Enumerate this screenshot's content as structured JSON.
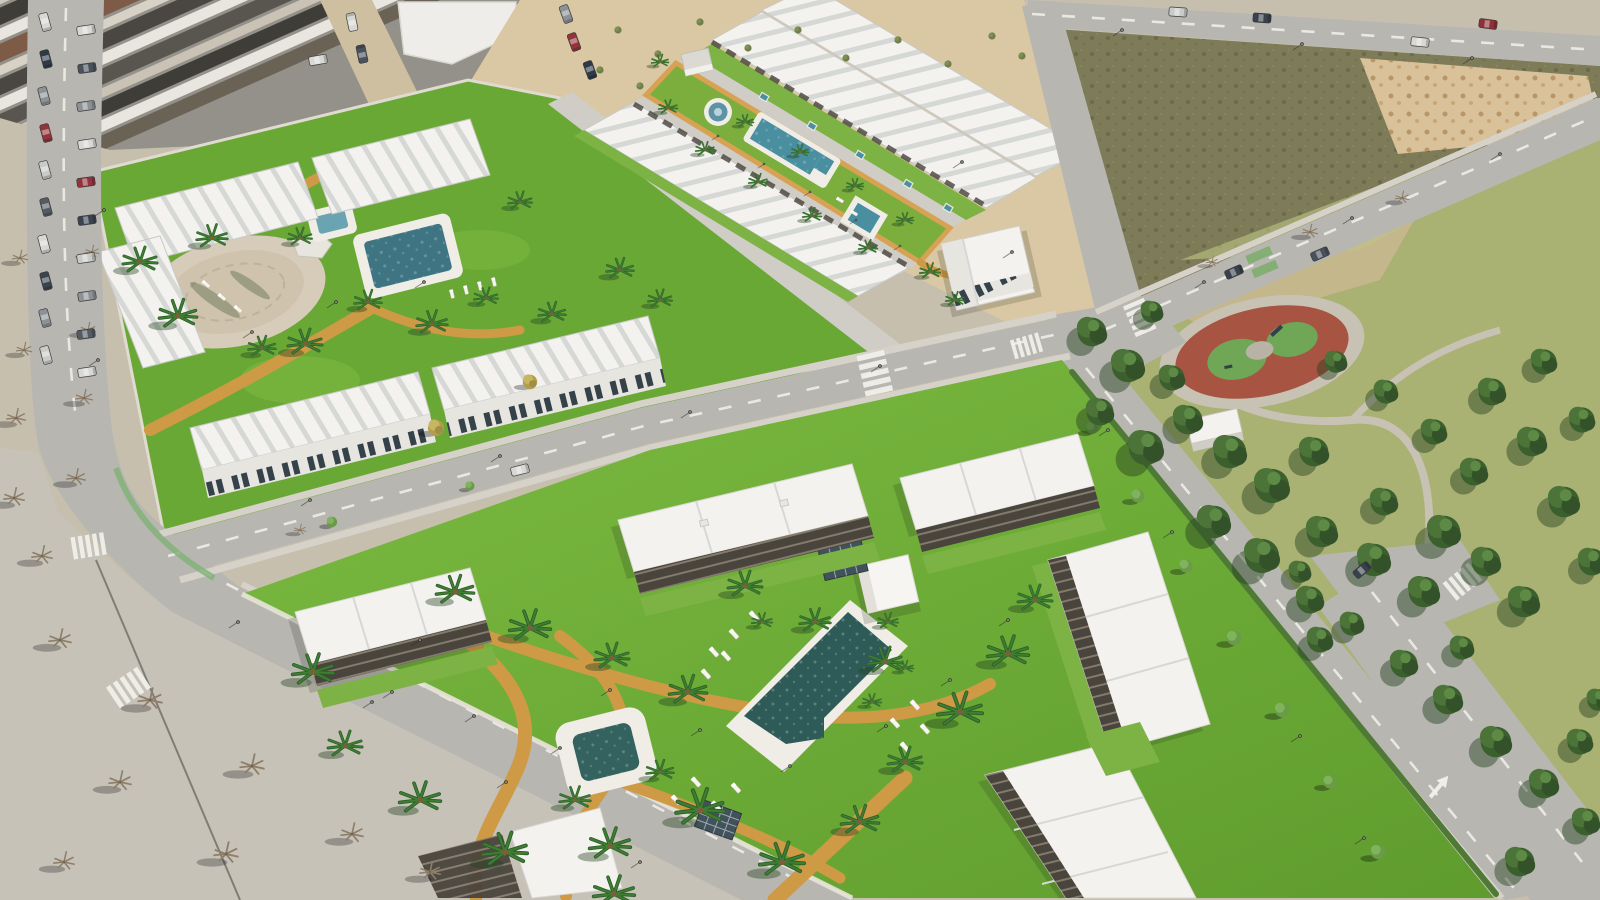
{
  "scene": {
    "description": "Oblique aerial 3D architectural render of two new-build white residential complexes with communal lawns, swimming pools and palm trees, beside an existing town, empty plots, a tree-filled public park with a red playground, and surrounding streets.",
    "view": "oblique aerial",
    "texts_visible": "none"
  },
  "regions": {
    "town": {
      "label": "existing town blocks with dark roofs and parked cars"
    },
    "left_street": {
      "label": "street with parked cars on both sides"
    },
    "plaza": {
      "label": "paved area with bare trees and long shadows"
    },
    "sand_lots": {
      "label": "sandy undeveloped strip"
    },
    "scrub_field": {
      "label": "dark scrub vacant plot"
    },
    "mound_field": {
      "label": "sandy plot with planting mounds"
    },
    "park": {
      "label": "public park with dense pines",
      "playground": "red circular playground with green play surfaces"
    },
    "dev_a": {
      "label": "upper-left residence community: lawns, round patio, two pools, townhouse rows"
    },
    "dev_b": {
      "label": "long strip community: central lawn with fountain, lap pool, plunge pool, flanking townhouse rows, corner villa"
    },
    "dev_c": {
      "label": "lower community: large lawn, main pool, square plunge pool, pergola cube, apartment blocks"
    },
    "roads": {
      "label": "asphalt roads with zebra crossings, dashes, turn arrow and street lamps"
    }
  },
  "colors": {
    "base": "#c6bfae",
    "town": "#94918a",
    "road": "#b7b6b1",
    "sidewalk": "#d6d2c9",
    "plaza": "#c6c2b8",
    "sand": "#d9c8a3",
    "scrub": "#7d7b58",
    "mound": "#d9c29a",
    "parkGrass": "#a9b173",
    "parkSand": "#c9b891",
    "lawnA": "#6aa836",
    "lawnC1": "#7cbb41",
    "lawnC2": "#5f9c2e",
    "stripLawn": "#7bae3c",
    "path": "#cf9a45",
    "deck": "#efede6",
    "water": "#2e5a58",
    "waterLight": "#4a8fa0",
    "roofWhite": "#f3f2ef",
    "roofShade": "#d6d8d6",
    "faceShade": "#e7e5e0",
    "windowDark": "#35424a",
    "pergola": "#49443c",
    "hedge": "#4e7a35",
    "garden": "#7cb344",
    "wall": "#e0dbd0",
    "lane": "#d0cdc6",
    "playRed": "#a85442",
    "playGreen": "#6fa757",
    "playPath": "#c8c2b4",
    "zebra": "#f2f1ec"
  },
  "stamps": [
    [
      "zebra",
      875,
      374,
      1,
      -103
    ],
    [
      "zebra",
      88,
      546,
      0.8,
      -9
    ],
    [
      "zebra",
      128,
      688,
      0.9,
      -34
    ],
    [
      "zebra",
      1140,
      318,
      0.8,
      -113
    ],
    [
      "zebra",
      1462,
      582,
      0.8,
      -39
    ],
    [
      "zebra",
      1026,
      346,
      0.7,
      -16
    ],
    [
      "bike",
      1262,
      262,
      1,
      -113
    ],
    [
      "mpool",
      764,
      97,
      1,
      31
    ],
    [
      "mpool",
      812,
      126,
      1,
      31
    ],
    [
      "mpool",
      860,
      155,
      1,
      31
    ],
    [
      "mpool",
      908,
      184,
      1,
      31
    ],
    [
      "mpool",
      948,
      208,
      1,
      31
    ],
    [
      "lounger",
      714,
      652,
      1,
      48
    ],
    [
      "lounger",
      734,
      634,
      1,
      48
    ],
    [
      "lounger",
      754,
      616,
      1,
      48
    ],
    [
      "lounger",
      706,
      674,
      1,
      48
    ],
    [
      "lounger",
      726,
      656,
      1,
      48
    ],
    [
      "lounger",
      895,
      723,
      1,
      48
    ],
    [
      "lounger",
      915,
      705,
      1,
      48
    ],
    [
      "lounger",
      905,
      747,
      1,
      48
    ],
    [
      "lounger",
      925,
      729,
      1,
      48
    ],
    [
      "lounger",
      676,
      800,
      1,
      48
    ],
    [
      "lounger",
      696,
      782,
      1,
      48
    ],
    [
      "lounger",
      716,
      806,
      1,
      48
    ],
    [
      "lounger",
      736,
      788,
      1,
      48
    ],
    [
      "lounger",
      452,
      294,
      0.8,
      76
    ],
    [
      "lounger",
      466,
      290,
      0.8,
      76
    ],
    [
      "lounger",
      480,
      286,
      0.8,
      76
    ],
    [
      "lounger",
      494,
      282,
      0.8,
      76
    ],
    [
      "lounger",
      206,
      284,
      0.8,
      40
    ],
    [
      "lounger",
      222,
      297,
      0.8,
      40
    ],
    [
      "lounger",
      238,
      309,
      0.8,
      40
    ],
    [
      "lounger",
      840,
      200,
      0.7,
      31
    ],
    [
      "lounger",
      854,
      213,
      0.7,
      31
    ],
    [
      "lamp",
      238,
      622
    ],
    [
      "lamp",
      372,
      702
    ],
    [
      "lamp",
      506,
      782
    ],
    [
      "lamp",
      640,
      862
    ],
    [
      "lamp",
      104,
      210
    ],
    [
      "lamp",
      98,
      360
    ],
    [
      "lamp",
      310,
      500
    ],
    [
      "lamp",
      500,
      456
    ],
    [
      "lamp",
      690,
      412
    ],
    [
      "lamp",
      880,
      366
    ],
    [
      "lamp",
      1204,
      282
    ],
    [
      "lamp",
      1352,
      218
    ],
    [
      "lamp",
      1500,
      154
    ],
    [
      "lamp",
      962,
      162
    ],
    [
      "lamp",
      1012,
      252
    ],
    [
      "lamp",
      1108,
      430
    ],
    [
      "lamp",
      1172,
      532
    ],
    [
      "lamp",
      1236,
      634
    ],
    [
      "lamp",
      1300,
      736
    ],
    [
      "lamp",
      1364,
      838
    ],
    [
      "lamp",
      1122,
      30
    ],
    [
      "lamp",
      1302,
      44
    ],
    [
      "lamp",
      1472,
      58
    ],
    [
      "lamp",
      718,
      136,
      0.7
    ],
    [
      "lamp",
      764,
      164,
      0.7
    ],
    [
      "lamp",
      810,
      192,
      0.7
    ],
    [
      "lamp",
      856,
      220,
      0.7
    ],
    [
      "lamp",
      900,
      246,
      0.7
    ],
    [
      "lamp",
      392,
      692
    ],
    [
      "lamp",
      474,
      716
    ],
    [
      "lamp",
      560,
      748
    ],
    [
      "lamp",
      420,
      640
    ],
    [
      "lamp",
      610,
      690
    ],
    [
      "lamp",
      700,
      730
    ],
    [
      "lamp",
      790,
      766
    ],
    [
      "lamp",
      886,
      726
    ],
    [
      "lamp",
      950,
      680
    ],
    [
      "lamp",
      1008,
      620
    ],
    [
      "lamp",
      252,
      332
    ],
    [
      "lamp",
      336,
      302
    ],
    [
      "lamp",
      424,
      282
    ],
    [
      "shrub",
      618,
      30
    ],
    [
      "shrub",
      658,
      54
    ],
    [
      "shrub",
      700,
      22
    ],
    [
      "shrub",
      748,
      48
    ],
    [
      "shrub",
      798,
      30
    ],
    [
      "shrub",
      846,
      58
    ],
    [
      "shrub",
      898,
      40
    ],
    [
      "shrub",
      948,
      64
    ],
    [
      "shrub",
      992,
      36
    ],
    [
      "shrub",
      1022,
      56
    ],
    [
      "shrub",
      600,
      70
    ],
    [
      "shrub",
      640,
      86
    ],
    [
      "bare",
      16,
      418,
      1.1
    ],
    [
      "bare",
      84,
      398,
      1
    ],
    [
      "bare",
      14,
      498,
      1.2
    ],
    [
      "bare",
      76,
      478,
      1.1
    ],
    [
      "bare",
      42,
      556,
      1.2
    ],
    [
      "bare",
      24,
      350,
      0.9
    ],
    [
      "bare",
      88,
      330,
      0.9
    ],
    [
      "bare",
      20,
      258,
      0.9
    ],
    [
      "bare",
      92,
      252,
      0.8
    ],
    [
      "bare",
      60,
      640,
      1.3
    ],
    [
      "bare",
      150,
      700,
      1.4
    ],
    [
      "bare",
      252,
      766,
      1.4
    ],
    [
      "bare",
      352,
      834,
      1.3
    ],
    [
      "bare",
      120,
      782,
      1.3
    ],
    [
      "bare",
      226,
      854,
      1.4
    ],
    [
      "bare",
      64,
      862,
      1.2
    ],
    [
      "bare",
      430,
      872,
      1.2
    ],
    [
      "bare",
      300,
      530,
      0.7
    ],
    [
      "bare",
      1310,
      232,
      0.9
    ],
    [
      "bare",
      1402,
      198,
      0.8
    ],
    [
      "bare",
      1212,
      262,
      0.7
    ],
    [
      "autumn",
      436,
      428,
      1
    ],
    [
      "autumn",
      530,
      382,
      0.9
    ],
    [
      "stree",
      332,
      522,
      0.8
    ],
    [
      "stree",
      470,
      486,
      0.7
    ],
    [
      "stree",
      1092,
      428,
      0.9
    ],
    [
      "stree",
      1138,
      496,
      1
    ],
    [
      "stree",
      1186,
      566,
      1
    ],
    [
      "stree",
      1234,
      638,
      1.1
    ],
    [
      "stree",
      1282,
      710,
      1.1
    ],
    [
      "stree",
      1330,
      782,
      1
    ],
    [
      "stree",
      1378,
      852,
      1.1
    ],
    [
      "pine",
      1092,
      332,
      1.6
    ],
    [
      "pine",
      1128,
      366,
      1.8
    ],
    [
      "pine",
      1100,
      412,
      1.5
    ],
    [
      "pine",
      1146,
      448,
      1.9
    ],
    [
      "pine",
      1188,
      420,
      1.6
    ],
    [
      "pine",
      1172,
      378,
      1.4
    ],
    [
      "pine",
      1230,
      452,
      1.8
    ],
    [
      "pine",
      1272,
      486,
      1.9
    ],
    [
      "pine",
      1314,
      452,
      1.6
    ],
    [
      "pine",
      1214,
      522,
      1.8
    ],
    [
      "pine",
      1262,
      556,
      1.9
    ],
    [
      "pine",
      1322,
      532,
      1.7
    ],
    [
      "pine",
      1374,
      560,
      1.8
    ],
    [
      "pine",
      1424,
      592,
      1.7
    ],
    [
      "pine",
      1384,
      502,
      1.5
    ],
    [
      "pine",
      1444,
      532,
      1.8
    ],
    [
      "pine",
      1486,
      562,
      1.6
    ],
    [
      "pine",
      1524,
      602,
      1.7
    ],
    [
      "pine",
      1474,
      472,
      1.5
    ],
    [
      "pine",
      1532,
      442,
      1.6
    ],
    [
      "pine",
      1564,
      502,
      1.7
    ],
    [
      "pine",
      1592,
      562,
      1.5
    ],
    [
      "pine",
      1434,
      432,
      1.4
    ],
    [
      "pine",
      1492,
      392,
      1.5
    ],
    [
      "pine",
      1544,
      362,
      1.4
    ],
    [
      "pine",
      1386,
      392,
      1.3
    ],
    [
      "pine",
      1336,
      362,
      1.2
    ],
    [
      "pine",
      1152,
      312,
      1.2
    ],
    [
      "pine",
      1582,
      420,
      1.4
    ],
    [
      "pine",
      1404,
      664,
      1.5
    ],
    [
      "pine",
      1448,
      700,
      1.6
    ],
    [
      "pine",
      1496,
      742,
      1.7
    ],
    [
      "pine",
      1544,
      784,
      1.6
    ],
    [
      "pine",
      1586,
      822,
      1.5
    ],
    [
      "pine",
      1520,
      862,
      1.6
    ],
    [
      "pine",
      1462,
      648,
      1.3
    ],
    [
      "pine",
      1580,
      742,
      1.4
    ],
    [
      "pine",
      1598,
      700,
      1.2
    ],
    [
      "pine",
      1352,
      624,
      1.3
    ],
    [
      "pine",
      1300,
      572,
      1.2
    ],
    [
      "pine",
      1310,
      600,
      1.5
    ],
    [
      "pine",
      1320,
      640,
      1.4
    ],
    [
      "palm",
      140,
      262,
      1
    ],
    [
      "palm",
      178,
      316,
      1.1
    ],
    [
      "palm",
      212,
      238,
      0.9
    ],
    [
      "palm",
      262,
      348,
      0.8
    ],
    [
      "palm",
      305,
      344,
      1
    ],
    [
      "palm",
      368,
      302,
      0.8
    ],
    [
      "palm",
      300,
      238,
      0.7
    ],
    [
      "palm",
      432,
      324,
      0.9
    ],
    [
      "palm",
      486,
      298,
      0.7
    ],
    [
      "palm",
      552,
      314,
      0.8
    ],
    [
      "palm",
      520,
      202,
      0.7
    ],
    [
      "palm",
      620,
      270,
      0.8
    ],
    [
      "palm",
      660,
      300,
      0.7
    ],
    [
      "palm",
      668,
      108,
      0.55
    ],
    [
      "palm",
      705,
      150,
      0.55
    ],
    [
      "palm",
      745,
      122,
      0.5
    ],
    [
      "palm",
      758,
      182,
      0.55
    ],
    [
      "palm",
      800,
      152,
      0.5
    ],
    [
      "palm",
      812,
      216,
      0.55
    ],
    [
      "palm",
      855,
      186,
      0.5
    ],
    [
      "palm",
      868,
      248,
      0.55
    ],
    [
      "palm",
      905,
      220,
      0.5
    ],
    [
      "palm",
      930,
      272,
      0.6
    ],
    [
      "palm",
      955,
      300,
      0.55
    ],
    [
      "palm",
      660,
      62,
      0.5
    ],
    [
      "palm",
      455,
      592,
      1.1
    ],
    [
      "palm",
      530,
      628,
      1.2
    ],
    [
      "palm",
      612,
      658,
      1
    ],
    [
      "palm",
      688,
      692,
      1.1
    ],
    [
      "palm",
      313,
      672,
      1.2
    ],
    [
      "palm",
      345,
      746,
      1
    ],
    [
      "palm",
      420,
      800,
      1.2
    ],
    [
      "palm",
      505,
      852,
      1.3
    ],
    [
      "palm",
      610,
      846,
      1.2
    ],
    [
      "palm",
      700,
      810,
      1.4
    ],
    [
      "palm",
      782,
      862,
      1.3
    ],
    [
      "palm",
      860,
      822,
      1.1
    ],
    [
      "palm",
      905,
      762,
      1
    ],
    [
      "palm",
      960,
      712,
      1.3
    ],
    [
      "palm",
      1008,
      654,
      1.2
    ],
    [
      "palm",
      1035,
      600,
      1
    ],
    [
      "palm",
      745,
      586,
      1
    ],
    [
      "palm",
      815,
      622,
      0.9
    ],
    [
      "palm",
      885,
      662,
      1
    ],
    [
      "palm",
      575,
      800,
      0.9
    ],
    [
      "palm",
      660,
      772,
      0.8
    ],
    [
      "palm",
      762,
      622,
      0.6
    ],
    [
      "palm",
      888,
      622,
      0.6
    ],
    [
      "palm",
      872,
      702,
      0.55
    ],
    [
      "palm",
      905,
      668,
      0.5
    ],
    [
      "palm",
      614,
      894,
      1.2
    ],
    [
      "car",
      45,
      22,
      1,
      75,
      "#d8d8d5"
    ],
    [
      "car",
      46,
      59,
      1,
      75,
      "#2f3a47"
    ],
    [
      "car",
      44,
      96,
      1,
      75,
      "#8d9196"
    ],
    [
      "car",
      46,
      133,
      1,
      75,
      "#93343c"
    ],
    [
      "car",
      45,
      170,
      1,
      75,
      "#c9cbc8"
    ],
    [
      "car",
      46,
      207,
      1,
      75,
      "#555b63"
    ],
    [
      "car",
      44,
      244,
      1,
      75,
      "#d8d8d5"
    ],
    [
      "car",
      46,
      281,
      1,
      75,
      "#394450"
    ],
    [
      "car",
      45,
      318,
      1,
      75,
      "#8d9196"
    ],
    [
      "car",
      46,
      355,
      1,
      75,
      "#caccc9"
    ],
    [
      "car",
      86,
      30,
      1,
      -8,
      "#d8d8d5"
    ],
    [
      "car",
      87,
      68,
      1,
      -8,
      "#49525c"
    ],
    [
      "car",
      86,
      106,
      1,
      -8,
      "#8d9196"
    ],
    [
      "car",
      87,
      144,
      1,
      -8,
      "#d8d8d5"
    ],
    [
      "car",
      86,
      182,
      1,
      -8,
      "#93343c"
    ],
    [
      "car",
      87,
      220,
      1,
      -8,
      "#394450"
    ],
    [
      "car",
      86,
      258,
      1,
      -8,
      "#c9cbc8"
    ],
    [
      "car",
      87,
      296,
      1,
      -8,
      "#8d9196"
    ],
    [
      "car",
      86,
      334,
      1,
      -8,
      "#555b63"
    ],
    [
      "car",
      87,
      372,
      1,
      -8,
      "#d8d8d5"
    ],
    [
      "car",
      352,
      22,
      1,
      -102,
      "#d8d8d5"
    ],
    [
      "car",
      362,
      54,
      1,
      -102,
      "#49525c"
    ],
    [
      "car",
      318,
      60,
      1,
      -10,
      "#d8d8d5"
    ],
    [
      "car",
      566,
      14,
      1,
      70,
      "#8d9196"
    ],
    [
      "car",
      574,
      42,
      1,
      70,
      "#93343c"
    ],
    [
      "car",
      590,
      70,
      1,
      70,
      "#2f3a47"
    ],
    [
      "car",
      1178,
      12,
      1,
      4,
      "#c9cbc8"
    ],
    [
      "car",
      1262,
      18,
      1,
      4,
      "#39414d"
    ],
    [
      "car",
      1420,
      42,
      1,
      6,
      "#d8d8d5"
    ],
    [
      "car",
      1488,
      24,
      1,
      8,
      "#8f2f38"
    ],
    [
      "car",
      1234,
      272,
      1,
      -24,
      "#39414d"
    ],
    [
      "car",
      1320,
      254,
      1,
      -24,
      "#49525c"
    ],
    [
      "car",
      1362,
      570,
      1,
      -40,
      "#39414d"
    ],
    [
      "car",
      520,
      470,
      1,
      -14,
      "#d8d8d5"
    ]
  ]
}
